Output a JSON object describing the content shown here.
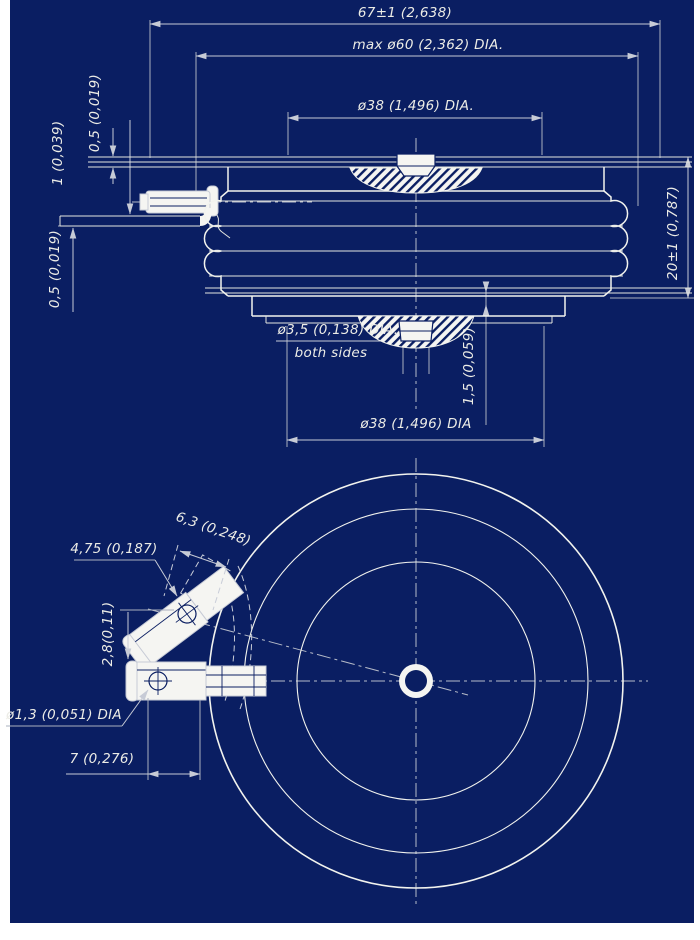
{
  "colors": {
    "sheet": "#0a1e62",
    "paper": "#ffffff",
    "object_line": "#f2f3ee",
    "dimension_line": "#c7cbd6",
    "text": "#ecece6"
  },
  "labels": {
    "overall_width": "67±1 (2,638)",
    "max_dia": "max ø60 (2,362) DIA.",
    "top_pole_dia": "ø38 (1,496) DIA.",
    "top_strap_thickness": "0,5 (0,019)",
    "gate_lead_thickness": "1 (0,039)",
    "bottom_strap_thickness": "0,5 (0,019)",
    "height": "20±1 (0,787)",
    "center_hole_dia": "ø3,5 (0,138) DIA.",
    "center_hole_note": "both sides",
    "recess_depth": "1,5 (0,059)",
    "bottom_pole_dia": "ø38 (1,496) DIA",
    "tab_width": "4,75 (0,187)",
    "tab_length": "6,3 (0,248)",
    "lead_offset": "2,8(0,11)",
    "lead_hole_dia": "ø1,3 (0,051) DIA",
    "lead_distance": "7 (0,276)"
  }
}
